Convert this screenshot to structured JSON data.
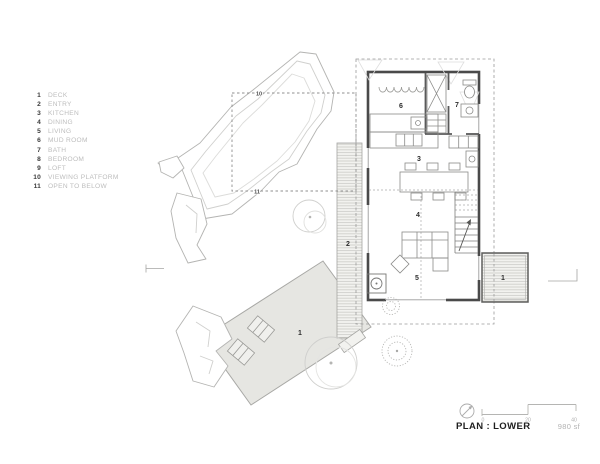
{
  "legend": {
    "items": [
      {
        "num": "1",
        "label": "DECK"
      },
      {
        "num": "2",
        "label": "ENTRY"
      },
      {
        "num": "3",
        "label": "KITCHEN"
      },
      {
        "num": "4",
        "label": "DINING"
      },
      {
        "num": "5",
        "label": "LIVING"
      },
      {
        "num": "6",
        "label": "MUD ROOM"
      },
      {
        "num": "7",
        "label": "BATH"
      },
      {
        "num": "8",
        "label": "BEDROOM"
      },
      {
        "num": "9",
        "label": "LOFT"
      },
      {
        "num": "10",
        "label": "VIEWING PLATFORM"
      },
      {
        "num": "11",
        "label": "OPEN TO BELOW"
      }
    ]
  },
  "plan": {
    "labels": {
      "deck_main": "1",
      "deck_side": "1",
      "entry": "2",
      "kitchen": "3",
      "dining": "4",
      "living": "5",
      "mudroom": "6",
      "bath": "7",
      "platform_top": "10",
      "platform_bottom": "11"
    }
  },
  "scalebar": {
    "ticks": [
      "0",
      "20",
      "40"
    ]
  },
  "titleblock": {
    "title": "PLAN : LOWER",
    "area": "980 sf"
  },
  "colors": {
    "wall": "#4a4a4a",
    "deck_fill": "#e6e6e2",
    "rock_line": "#b4b4b2",
    "tree_line": "#cfcfcd",
    "dash_line": "#9a9a9a",
    "label_muted": "#bdbdbd",
    "text_dark": "#1f1f1f"
  }
}
